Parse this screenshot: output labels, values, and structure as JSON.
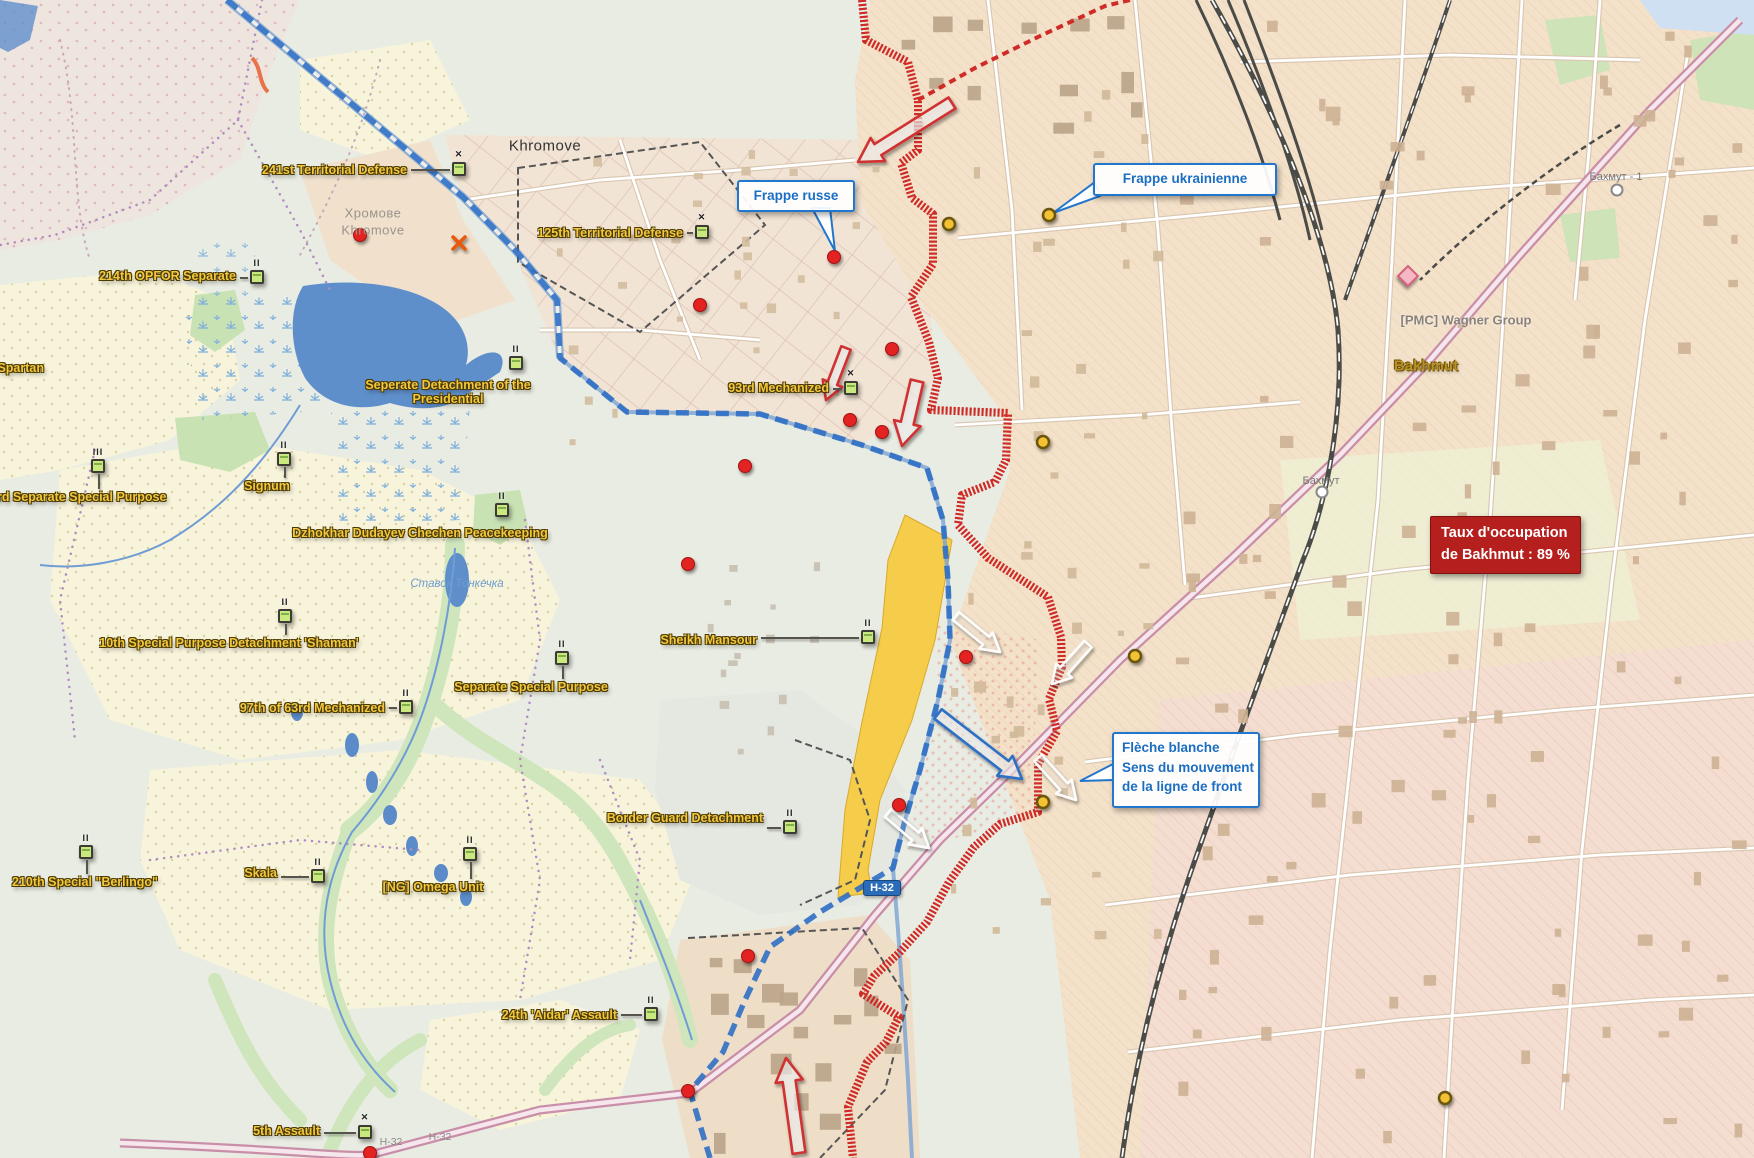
{
  "colors": {
    "unit_label": "#f3c73f",
    "callout_blue": "#1b6ec2",
    "front_red": "#cf2b27",
    "front_blue": "#2f6fc4",
    "occupation_box_bg": "#b5201e",
    "red_dot": "#e32222",
    "yellow_dot": "#f2c233",
    "water": "#5f8fcb",
    "field_yellow": "#f6cd4b"
  },
  "legend_boxes": {
    "frappe_russe": {
      "label": "Frappe russe",
      "x": 737,
      "y": 180,
      "w": 118,
      "h": 30,
      "tail": [
        [
          812,
          208
        ],
        [
          830,
          208
        ],
        [
          835,
          251
        ]
      ]
    },
    "frappe_ukrainienne": {
      "label": "Frappe ukrainienne",
      "x": 1093,
      "y": 163,
      "w": 184,
      "h": 33,
      "tail": [
        [
          1095,
          182
        ],
        [
          1100,
          196
        ],
        [
          1053,
          213
        ]
      ]
    },
    "fleche_blanche": {
      "lines": [
        "Flèche blanche",
        "Sens du mouvement",
        "de la ligne de front"
      ],
      "x": 1112,
      "y": 732,
      "w": 148,
      "h": 76,
      "tail": [
        [
          1113,
          764
        ],
        [
          1113,
          780
        ],
        [
          1080,
          781
        ]
      ]
    }
  },
  "occupation_box": {
    "lines": [
      "Taux d'occupation",
      "de Bakhmut : 89 %"
    ],
    "x": 1430,
    "y": 516
  },
  "road_badge": {
    "label": "H-32",
    "x": 882,
    "y": 888
  },
  "place_labels": [
    {
      "text": "Khromove",
      "x": 545,
      "y": 146,
      "cls": "town"
    },
    {
      "text": "Хромове",
      "x": 373,
      "y": 213,
      "cls": "ghost"
    },
    {
      "text": "Khromove",
      "x": 373,
      "y": 230,
      "cls": "ghost"
    },
    {
      "text": "[PMC] Wagner Group",
      "x": 1466,
      "y": 320,
      "cls": "poi"
    },
    {
      "text": "Bakhmut",
      "x": 1426,
      "y": 366,
      "cls": "city"
    },
    {
      "text": "Бахмут - 1",
      "x": 1616,
      "y": 177,
      "cls": "station"
    },
    {
      "text": "Бахмут",
      "x": 1321,
      "y": 481,
      "cls": "station"
    },
    {
      "text": "Ставок Тонкечка",
      "x": 457,
      "y": 584,
      "cls": "water"
    },
    {
      "text": "Н-32",
      "x": 391,
      "y": 1142,
      "cls": "roadref"
    },
    {
      "text": "Н-32",
      "x": 440,
      "y": 1137,
      "cls": "roadref"
    }
  ],
  "units": [
    {
      "label": "241st Territorial Defense",
      "tx": 407,
      "ty": 170,
      "anchor": "end",
      "icon": {
        "x": 459,
        "y": 169
      },
      "echelon": "x",
      "conn": "h"
    },
    {
      "label": "214th OPFOR Separate",
      "tx": 236,
      "ty": 276,
      "anchor": "end",
      "icon": {
        "x": 257,
        "y": 277
      },
      "echelon": "II",
      "conn": "h"
    },
    {
      "label": "125th Territorial Defense",
      "tx": 683,
      "ty": 233,
      "anchor": "end",
      "icon": {
        "x": 702,
        "y": 232
      },
      "echelon": "x",
      "conn": "h"
    },
    {
      "lines": [
        "Seperate Detachment of the",
        "Presidential"
      ],
      "tx": 448,
      "ty": 392,
      "anchor": "middle",
      "icon": {
        "x": 516,
        "y": 363
      },
      "echelon": "II",
      "conn": null
    },
    {
      "label": "Signum",
      "tx": 267,
      "ty": 486,
      "anchor": "middle",
      "icon": {
        "x": 284,
        "y": 459
      },
      "echelon": "II",
      "conn": "v"
    },
    {
      "label": "3rd Separate Special Purpose",
      "tx": -10,
      "ty": 497,
      "anchor": "start",
      "icon": {
        "x": 98,
        "y": 466
      },
      "echelon": "III",
      "conn": "v"
    },
    {
      "label": "Dzhokhar Dudayev Chechen Peacekeeping",
      "tx": 420,
      "ty": 533,
      "anchor": "middle",
      "icon": {
        "x": 502,
        "y": 510
      },
      "echelon": "II",
      "conn": null
    },
    {
      "label": "10th Special Purpose Detachment 'Shaman'",
      "tx": 229,
      "ty": 643,
      "anchor": "middle",
      "icon": {
        "x": 285,
        "y": 616
      },
      "echelon": "II",
      "conn": "v"
    },
    {
      "label": "Separate Special Purpose",
      "tx": 531,
      "ty": 687,
      "anchor": "middle",
      "icon": {
        "x": 562,
        "y": 658
      },
      "echelon": "II",
      "conn": "v"
    },
    {
      "label": "Sheikh Mansour",
      "tx": 757,
      "ty": 640,
      "anchor": "end",
      "icon": {
        "x": 868,
        "y": 637
      },
      "echelon": "II",
      "conn": "h"
    },
    {
      "label": "97th of 63rd Mechanized",
      "tx": 385,
      "ty": 708,
      "anchor": "end",
      "icon": {
        "x": 406,
        "y": 707
      },
      "echelon": "II",
      "conn": "h"
    },
    {
      "label": "Border Guard Detachment",
      "tx": 763,
      "ty": 818,
      "anchor": "end",
      "icon": {
        "x": 790,
        "y": 827
      },
      "echelon": "II",
      "conn": "h"
    },
    {
      "label": "Skala",
      "tx": 277,
      "ty": 873,
      "anchor": "end",
      "icon": {
        "x": 318,
        "y": 876
      },
      "echelon": "II",
      "conn": "h"
    },
    {
      "label": "210th Special \"Berlingo\"",
      "tx": 85,
      "ty": 882,
      "anchor": "middle",
      "icon": {
        "x": 86,
        "y": 852
      },
      "echelon": "II",
      "conn": "v"
    },
    {
      "label": "[NG] Omega Unit",
      "tx": 433,
      "ty": 887,
      "anchor": "middle",
      "icon": {
        "x": 470,
        "y": 854
      },
      "echelon": "II",
      "conn": "v"
    },
    {
      "label": "24th 'Aidar' Assault",
      "tx": 617,
      "ty": 1015,
      "anchor": "end",
      "icon": {
        "x": 651,
        "y": 1014
      },
      "echelon": "II",
      "conn": "h"
    },
    {
      "label": "5th Assault",
      "tx": 320,
      "ty": 1131,
      "anchor": "end",
      "icon": {
        "x": 365,
        "y": 1132
      },
      "echelon": "x",
      "conn": "h"
    },
    {
      "label": "93rd Mechanized",
      "tx": 829,
      "ty": 388,
      "anchor": "end",
      "icon": {
        "x": 851,
        "y": 388
      },
      "echelon": "x",
      "conn": "h"
    },
    {
      "label": "Spartan",
      "tx": 44,
      "ty": 368,
      "anchor": "end",
      "icon": null,
      "echelon": null,
      "conn": null
    }
  ],
  "markers": {
    "red_dots": [
      [
        360,
        235
      ],
      [
        834,
        257
      ],
      [
        700,
        305
      ],
      [
        892,
        349
      ],
      [
        850,
        420
      ],
      [
        882,
        432
      ],
      [
        745,
        466
      ],
      [
        688,
        564
      ],
      [
        966,
        657
      ],
      [
        899,
        805
      ],
      [
        748,
        956
      ],
      [
        688,
        1091
      ],
      [
        370,
        1153
      ]
    ],
    "yellow_dots": [
      [
        949,
        224
      ],
      [
        1049,
        215
      ],
      [
        1043,
        442
      ],
      [
        1135,
        656
      ],
      [
        1043,
        802
      ],
      [
        1445,
        1098
      ]
    ],
    "diamond": {
      "x": 1408,
      "y": 276
    },
    "x_mark": {
      "x": 459,
      "y": 243
    },
    "stations": [
      [
        1617,
        190
      ],
      [
        1322,
        492
      ]
    ]
  },
  "arrows": [
    {
      "color": "red",
      "x1": 952,
      "y1": 103,
      "x2": 858,
      "y2": 162,
      "w": 13
    },
    {
      "color": "red",
      "x1": 846,
      "y1": 348,
      "x2": 826,
      "y2": 400,
      "w": 10
    },
    {
      "color": "red",
      "x1": 917,
      "y1": 381,
      "x2": 902,
      "y2": 446,
      "w": 13
    },
    {
      "color": "red",
      "x1": 799,
      "y1": 1153,
      "x2": 786,
      "y2": 1058,
      "w": 13
    },
    {
      "color": "white",
      "x1": 956,
      "y1": 616,
      "x2": 1000,
      "y2": 652,
      "w": 10
    },
    {
      "color": "white",
      "x1": 1088,
      "y1": 644,
      "x2": 1052,
      "y2": 684,
      "w": 10
    },
    {
      "color": "white",
      "x1": 1038,
      "y1": 758,
      "x2": 1076,
      "y2": 800,
      "w": 10
    },
    {
      "color": "white",
      "x1": 888,
      "y1": 813,
      "x2": 929,
      "y2": 848,
      "w": 10
    },
    {
      "color": "blue",
      "x1": 938,
      "y1": 714,
      "x2": 1022,
      "y2": 779,
      "w": 12
    }
  ]
}
